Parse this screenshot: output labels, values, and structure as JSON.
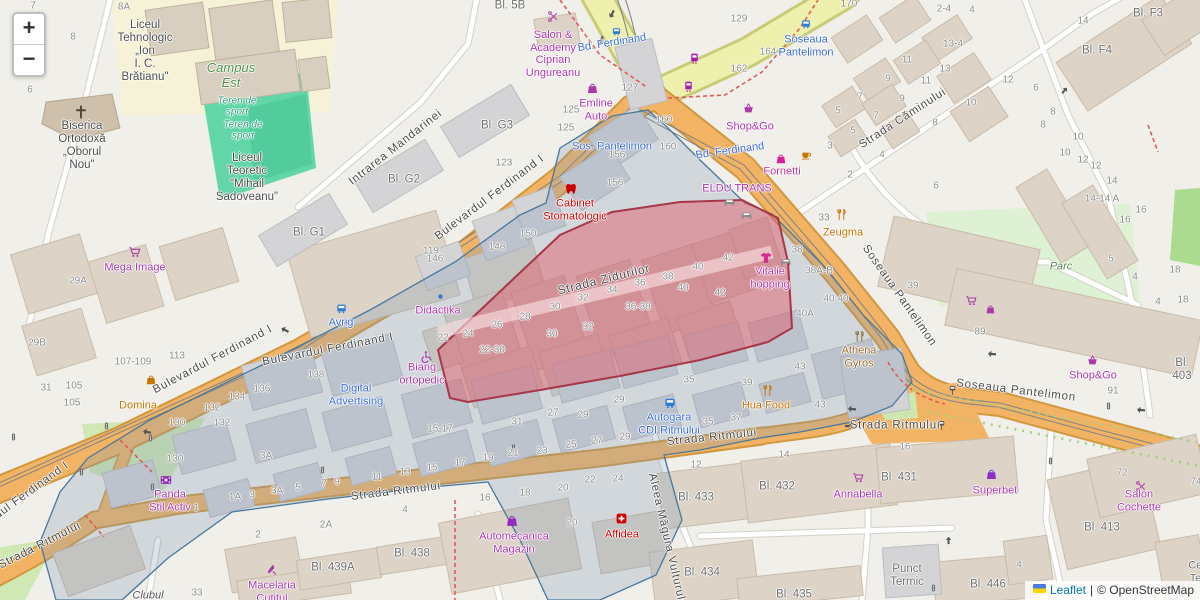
{
  "controls": {
    "zoom_in": "+",
    "zoom_out": "−"
  },
  "attribution": {
    "leaflet": "Leaflet",
    "sep": "|",
    "osm": "© OpenStreetMap"
  },
  "colors": {
    "land": "#f1efe9",
    "road_primary": "#f2b464",
    "road_primary_casing": "#d0973e",
    "road_secondary": "#eef0ad",
    "road_secondary_casing": "#c9cc77",
    "road_minor": "#ffffff",
    "road_minor_casing": "#d4d0ca",
    "building": "#ddd3c6",
    "building_gray": "#d4d4d6",
    "pitch_green": "#62d6a8",
    "park_green": "#dff1d4",
    "grass_green": "#cfe8b4",
    "schoolyard": "#f5f2d8",
    "selection_fill": "#e25563",
    "selection_stroke": "#a83648",
    "district_fill": "#7d96b4",
    "district_stroke": "#46789e",
    "poi_purple": "#ac39ac",
    "poi_blue": "#3a6cd4",
    "poi_orange": "#c77400",
    "poi_red": "#cc0000",
    "street_label": "#4a4a4a",
    "number_label": "#8b8b8b",
    "block_label": "#6e6e6e"
  },
  "streets": [
    {
      "t": "Bulevardul Ferdinand I",
      "x": 490,
      "y": 198,
      "r": -37
    },
    {
      "t": "Bulevardul Ferdinand I",
      "x": 213,
      "y": 360,
      "r": -28
    },
    {
      "t": "Bulevardul Ferdinand I",
      "x": 328,
      "y": 350,
      "r": -11
    },
    {
      "t": "Bulevardul Ferdinand I",
      "x": 14,
      "y": 504,
      "r": -36
    },
    {
      "t": "Strada Zidurilor",
      "x": 604,
      "y": 280,
      "r": -14,
      "s": 12
    },
    {
      "t": "Strada Căminului",
      "x": 903,
      "y": 119,
      "r": -33
    },
    {
      "t": "Intrarea Mandarinei",
      "x": 396,
      "y": 148,
      "r": -38
    },
    {
      "t": "Soseaua Pantelimon",
      "x": 899,
      "y": 296,
      "r": 55
    },
    {
      "t": "Soseaua Pantelimon",
      "x": 1016,
      "y": 391,
      "r": 7
    },
    {
      "t": "Strada Ritmului",
      "x": 396,
      "y": 492,
      "r": -7
    },
    {
      "t": "Strada Ritmului",
      "x": 712,
      "y": 438,
      "r": -6
    },
    {
      "t": "Strada Ritmului",
      "x": 895,
      "y": 426,
      "r": 0
    },
    {
      "t": "Strada Ritmului",
      "x": 40,
      "y": 546,
      "r": -27
    },
    {
      "t": "Aleea Măgura Vulturului",
      "x": 667,
      "y": 542,
      "r": 77
    }
  ],
  "places": [
    {
      "t": "Liceul\nTehnologic\n„Ion\nI. C.\nBrătianu\"",
      "x": 145,
      "y": 52,
      "c": "#4d4d4d",
      "s": 11.5
    },
    {
      "t": "Campus\nEst",
      "x": 231,
      "y": 76,
      "c": "#4c9245",
      "s": 13,
      "i": true
    },
    {
      "t": "Teren de\nsport",
      "x": 237,
      "y": 107,
      "c": "#2f9e82",
      "s": 10,
      "i": true
    },
    {
      "t": "Teren de\nsport",
      "x": 243,
      "y": 131,
      "c": "#2f9e82",
      "s": 10,
      "i": true
    },
    {
      "t": "Biserica\nOrtodoxă\n„Oborul\nNou\"",
      "x": 82,
      "y": 146,
      "c": "#4d4d4d",
      "s": 11.5
    },
    {
      "t": "Liceul\nTeoretic\n\"Mihail\nSadoveanu\"",
      "x": 247,
      "y": 178,
      "c": "#4d4d4d",
      "s": 11.5
    },
    {
      "t": "Mega Image",
      "x": 135,
      "y": 268,
      "c": "#ac39ac"
    },
    {
      "t": "Salon &\nAcademy\nCiprian\nUngureanu",
      "x": 553,
      "y": 54,
      "c": "#ac39ac"
    },
    {
      "t": "Emline\nAuto",
      "x": 596,
      "y": 110,
      "c": "#ac39ac"
    },
    {
      "t": "Bd. Ferdinand",
      "x": 612,
      "y": 43,
      "c": "#3a6cd4",
      "r": -9
    },
    {
      "t": "Bd. Ferdinand",
      "x": 730,
      "y": 151,
      "c": "#3a6cd4",
      "r": -8
    },
    {
      "t": "Sos. Pantelimon",
      "x": 612,
      "y": 147,
      "c": "#3a6cd4"
    },
    {
      "t": "Soseaua\nPantelimon",
      "x": 806,
      "y": 46,
      "c": "#3a6cd4"
    },
    {
      "t": "Shop&Go",
      "x": 750,
      "y": 127,
      "c": "#ac39ac"
    },
    {
      "t": "Fornetti",
      "x": 782,
      "y": 172,
      "c": "#c23a9b"
    },
    {
      "t": "ELDU TRANS",
      "x": 737,
      "y": 189,
      "c": "#ac39ac"
    },
    {
      "t": "Cabinet\nStomatologic",
      "x": 575,
      "y": 210,
      "c": "#cc0000"
    },
    {
      "t": "Didactika",
      "x": 438,
      "y": 311,
      "c": "#ac39ac"
    },
    {
      "t": "Vitalie\nhopping",
      "x": 770,
      "y": 278,
      "c": "#bc34a0"
    },
    {
      "t": "Zeugma",
      "x": 843,
      "y": 233,
      "c": "#c77400"
    },
    {
      "t": "Parc",
      "x": 1061,
      "y": 267,
      "c": "#568a56",
      "i": true
    },
    {
      "t": "Athena\nGyros",
      "x": 859,
      "y": 357,
      "c": "#9c6b2f"
    },
    {
      "t": "Shop&Go",
      "x": 1093,
      "y": 376,
      "c": "#ac39ac"
    },
    {
      "t": "Avrig",
      "x": 341,
      "y": 323,
      "c": "#3a6cd4"
    },
    {
      "t": "Digital\nAdvertising",
      "x": 356,
      "y": 395,
      "c": "#3a6cd4"
    },
    {
      "t": "Biang\nortopedic",
      "x": 422,
      "y": 374,
      "c": "#ac39ac"
    },
    {
      "t": "Autogara\nCDI Ritmului",
      "x": 669,
      "y": 424,
      "c": "#3a6cd4"
    },
    {
      "t": "Hua Food",
      "x": 766,
      "y": 406,
      "c": "#c77400"
    },
    {
      "t": "Panda\nStil Activ",
      "x": 170,
      "y": 501,
      "c": "#ac39ac"
    },
    {
      "t": "Domina",
      "x": 138,
      "y": 406,
      "c": "#c77400"
    },
    {
      "t": "Macelaria\nCutitul",
      "x": 272,
      "y": 592,
      "c": "#ac39ac"
    },
    {
      "t": "Automecanica\nMagazin",
      "x": 514,
      "y": 543,
      "c": "#ac39ac"
    },
    {
      "t": "Affidea",
      "x": 622,
      "y": 535,
      "c": "#cc0000"
    },
    {
      "t": "Annabella",
      "x": 858,
      "y": 495,
      "c": "#ac39ac"
    },
    {
      "t": "Superbet",
      "x": 995,
      "y": 491,
      "c": "#ac39ac"
    },
    {
      "t": "Salon Cochette",
      "x": 1139,
      "y": 501,
      "c": "#ac39ac"
    },
    {
      "t": "Punct\nTermic",
      "x": 907,
      "y": 576,
      "c": "#6e6e6e",
      "s": 11.5
    },
    {
      "t": "Clubul",
      "x": 148,
      "y": 596,
      "c": "#555555",
      "i": true
    },
    {
      "t": "Centrala\nTermica",
      "x": 1209,
      "y": 572,
      "c": "#6e6e6e"
    },
    {
      "t": "Bl. G3",
      "x": 497,
      "y": 126,
      "c": "#6e6e6e",
      "s": 11.5
    },
    {
      "t": "Bl. G2",
      "x": 404,
      "y": 180,
      "c": "#6e6e6e",
      "s": 11.5
    },
    {
      "t": "Bl. G1",
      "x": 309,
      "y": 233,
      "c": "#6e6e6e",
      "s": 11.5
    },
    {
      "t": "Bl. 5B",
      "x": 510,
      "y": 6,
      "c": "#6e6e6e",
      "s": 11.5
    },
    {
      "t": "Bl. F3",
      "x": 1148,
      "y": 14,
      "c": "#6e6e6e",
      "s": 11.5
    },
    {
      "t": "Bl. F4",
      "x": 1097,
      "y": 51,
      "c": "#6e6e6e",
      "s": 11.5
    },
    {
      "t": "Bl. 403",
      "x": 1182,
      "y": 370,
      "c": "#6e6e6e",
      "s": 11.5
    },
    {
      "t": "Bl. 433",
      "x": 696,
      "y": 498,
      "c": "#6e6e6e",
      "s": 11.5
    },
    {
      "t": "Bl. 432",
      "x": 777,
      "y": 487,
      "c": "#6e6e6e",
      "s": 11.5
    },
    {
      "t": "Bl. 431",
      "x": 899,
      "y": 478,
      "c": "#6e6e6e",
      "s": 11.5
    },
    {
      "t": "Bl. 434",
      "x": 702,
      "y": 573,
      "c": "#6e6e6e",
      "s": 11.5
    },
    {
      "t": "Bl. 435",
      "x": 794,
      "y": 595,
      "c": "#6e6e6e",
      "s": 11.5
    },
    {
      "t": "Bl. 446",
      "x": 988,
      "y": 585,
      "c": "#6e6e6e",
      "s": 11.5
    },
    {
      "t": "Bl. 413",
      "x": 1102,
      "y": 528,
      "c": "#6e6e6e",
      "s": 11.5
    },
    {
      "t": "Bl. 439A",
      "x": 333,
      "y": 568,
      "c": "#6e6e6e",
      "s": 11.5
    },
    {
      "t": "Bl. 438",
      "x": 412,
      "y": 554,
      "c": "#6e6e6e",
      "s": 11.5
    }
  ],
  "numbers": [
    [
      "7",
      33,
      6
    ],
    [
      "8A",
      124,
      7
    ],
    [
      "8",
      73,
      37
    ],
    [
      "6",
      30,
      90
    ],
    [
      "129",
      739,
      19
    ],
    [
      "162",
      739,
      69
    ],
    [
      "164",
      768,
      52
    ],
    [
      "170",
      849,
      4
    ],
    [
      "2-4",
      944,
      9
    ],
    [
      "4",
      972,
      10
    ],
    [
      "13-4",
      953,
      44
    ],
    [
      "13",
      945,
      69
    ],
    [
      "11",
      907,
      60
    ],
    [
      "11",
      926,
      81
    ],
    [
      "9",
      888,
      79
    ],
    [
      "9",
      902,
      99
    ],
    [
      "7",
      860,
      97
    ],
    [
      "7",
      876,
      116
    ],
    [
      "5",
      838,
      111
    ],
    [
      "5",
      853,
      131
    ],
    [
      "3",
      830,
      146
    ],
    [
      "4",
      882,
      155
    ],
    [
      "2",
      850,
      175
    ],
    [
      "6",
      936,
      186
    ],
    [
      "8",
      935,
      123
    ],
    [
      "10",
      971,
      103
    ],
    [
      "12",
      1008,
      80
    ],
    [
      "6",
      1036,
      88
    ],
    [
      "8",
      1053,
      112
    ],
    [
      "8",
      1043,
      125
    ],
    [
      "10",
      1078,
      137
    ],
    [
      "10",
      1065,
      153
    ],
    [
      "12",
      1083,
      160
    ],
    [
      "12",
      1096,
      166
    ],
    [
      "14",
      1112,
      181
    ],
    [
      "14",
      1083,
      21
    ],
    [
      "14-14 A",
      1102,
      199
    ],
    [
      "16",
      1141,
      210
    ],
    [
      "16",
      1125,
      220
    ],
    [
      "127",
      630,
      88
    ],
    [
      "125",
      571,
      110
    ],
    [
      "125",
      566,
      128
    ],
    [
      "123",
      504,
      163
    ],
    [
      "119",
      431,
      251
    ],
    [
      "150",
      528,
      234
    ],
    [
      "148",
      497,
      247
    ],
    [
      "146",
      435,
      259
    ],
    [
      "156",
      617,
      155
    ],
    [
      "156",
      615,
      183
    ],
    [
      "160",
      664,
      120
    ],
    [
      "160",
      668,
      147
    ],
    [
      "22",
      443,
      338
    ],
    [
      "24",
      468,
      334
    ],
    [
      "26",
      497,
      325
    ],
    [
      "28",
      525,
      317
    ],
    [
      "30",
      555,
      307
    ],
    [
      "30",
      552,
      334
    ],
    [
      "32",
      583,
      298
    ],
    [
      "32",
      588,
      327
    ],
    [
      "34",
      612,
      290
    ],
    [
      "36",
      640,
      283
    ],
    [
      "36-38",
      638,
      307
    ],
    [
      "38",
      668,
      277
    ],
    [
      "40",
      698,
      267
    ],
    [
      "40",
      683,
      288
    ],
    [
      "42",
      728,
      258
    ],
    [
      "42",
      720,
      293
    ],
    [
      "22-30",
      492,
      350
    ],
    [
      "38",
      797,
      250
    ],
    [
      "38A-B",
      819,
      271
    ],
    [
      "40",
      829,
      299
    ],
    [
      "40",
      843,
      299
    ],
    [
      "40A",
      805,
      314
    ],
    [
      "33",
      824,
      218
    ],
    [
      "39",
      913,
      286
    ],
    [
      "89",
      980,
      332
    ],
    [
      "91",
      1113,
      391
    ],
    [
      "5",
      1111,
      259
    ],
    [
      "4",
      1135,
      277
    ],
    [
      "18",
      1175,
      270
    ],
    [
      "4",
      1158,
      302
    ],
    [
      "18",
      1183,
      300
    ],
    [
      "9",
      337,
      482
    ],
    [
      "11",
      377,
      477
    ],
    [
      "13",
      405,
      472
    ],
    [
      "15",
      432,
      468
    ],
    [
      "17",
      460,
      463
    ],
    [
      "19",
      488,
      458
    ],
    [
      "21",
      513,
      453
    ],
    [
      "23",
      542,
      451
    ],
    [
      "25",
      571,
      445
    ],
    [
      "27",
      597,
      441
    ],
    [
      "29",
      625,
      437
    ],
    [
      "15-17",
      440,
      429
    ],
    [
      "31",
      517,
      422
    ],
    [
      "27",
      553,
      413
    ],
    [
      "29",
      583,
      415
    ],
    [
      "29",
      619,
      400
    ],
    [
      "35",
      689,
      380
    ],
    [
      "39",
      747,
      383
    ],
    [
      "43",
      800,
      367
    ],
    [
      "35",
      708,
      422
    ],
    [
      "37",
      736,
      418
    ],
    [
      "43",
      820,
      405
    ],
    [
      "4",
      405,
      510
    ],
    [
      "16",
      485,
      498
    ],
    [
      "18",
      525,
      493
    ],
    [
      "20",
      563,
      488
    ],
    [
      "22",
      590,
      480
    ],
    [
      "24",
      618,
      479
    ],
    [
      "20",
      572,
      523
    ],
    [
      "12",
      696,
      465
    ],
    [
      "14",
      784,
      455
    ],
    [
      "16",
      905,
      447
    ],
    [
      "2",
      258,
      535
    ],
    [
      "2A",
      326,
      525
    ],
    [
      "1",
      196,
      508
    ],
    [
      "1A",
      235,
      497
    ],
    [
      "3",
      252,
      495
    ],
    [
      "3A",
      277,
      491
    ],
    [
      "5",
      298,
      488
    ],
    [
      "7",
      324,
      484
    ],
    [
      "3A",
      266,
      456
    ],
    [
      "33",
      197,
      593
    ],
    [
      "31",
      46,
      388
    ],
    [
      "105",
      74,
      386
    ],
    [
      "105",
      72,
      403
    ],
    [
      "107-109",
      133,
      362
    ],
    [
      "113",
      177,
      356
    ],
    [
      "130",
      177,
      423
    ],
    [
      "132",
      212,
      408
    ],
    [
      "132",
      222,
      423
    ],
    [
      "134",
      237,
      397
    ],
    [
      "136",
      262,
      389
    ],
    [
      "138",
      316,
      375
    ],
    [
      "130",
      175,
      459
    ],
    [
      "29A",
      78,
      281
    ],
    [
      "29B",
      37,
      343
    ],
    [
      "72",
      1122,
      473
    ],
    [
      "74",
      1196,
      482
    ],
    [
      "4",
      1019,
      565
    ]
  ],
  "icons": [
    [
      "cart",
      135,
      252,
      "#ac39ac",
      14,
      0
    ],
    [
      "cart",
      971,
      300,
      "#ac39ac",
      13,
      0
    ],
    [
      "cart",
      858,
      477,
      "#ac39ac",
      13,
      0
    ],
    [
      "bag",
      990,
      309,
      "#ac39ac",
      11,
      0
    ],
    [
      "basket",
      748,
      108,
      "#ac39ac",
      13,
      0
    ],
    [
      "basket",
      1092,
      360,
      "#ac39ac",
      13,
      0
    ],
    [
      "bag",
      592,
      88,
      "#ac39ac",
      13,
      0
    ],
    [
      "bag",
      781,
      159,
      "#d81b9b",
      12,
      0
    ],
    [
      "bag",
      151,
      380,
      "#c77400",
      12,
      0
    ],
    [
      "bag",
      512,
      521,
      "#9429bd",
      14,
      0
    ],
    [
      "bag",
      991,
      474,
      "#8b2fc9",
      13,
      0
    ],
    [
      "scissors",
      553,
      16,
      "#ac39ac",
      13,
      0
    ],
    [
      "scissors",
      1141,
      486,
      "#ac39ac",
      13,
      0
    ],
    [
      "tram",
      694,
      58,
      "#a21caf",
      13,
      0
    ],
    [
      "tram",
      688,
      86,
      "#a21caf",
      13,
      0
    ],
    [
      "bus",
      806,
      24,
      "#2e7cd6",
      12,
      0
    ],
    [
      "bus",
      616,
      31,
      "#2e7cd6",
      11,
      0
    ],
    [
      "bus",
      341,
      308,
      "#2e7cd6",
      13,
      0
    ],
    [
      "bus",
      670,
      403,
      "#2e7cd6",
      14,
      0
    ],
    [
      "cup",
      806,
      155,
      "#c77400",
      12,
      0
    ],
    [
      "tooth",
      571,
      189,
      "#cc0000",
      14,
      0
    ],
    [
      "medcross",
      621,
      518,
      "#d40000",
      13,
      0
    ],
    [
      "fork",
      841,
      214,
      "#c77400",
      13,
      0
    ],
    [
      "fork",
      767,
      390,
      "#c77400",
      13,
      0
    ],
    [
      "fork",
      859,
      336,
      "#8a6d3b",
      13,
      0
    ],
    [
      "shirt",
      766,
      258,
      "#d52b8f",
      14,
      0
    ],
    [
      "film",
      166,
      480,
      "#9429bd",
      14,
      0
    ],
    [
      "knife",
      271,
      569,
      "#ac39ac",
      13,
      0
    ],
    [
      "crossch",
      81,
      112,
      "#4f463a",
      16,
      0
    ],
    [
      "wheelchair",
      426,
      356,
      "#ac39ac",
      13,
      0
    ],
    [
      "car",
      729,
      201,
      "#8a8a8a",
      13,
      0
    ],
    [
      "car",
      746,
      214,
      "#8a8a8a",
      13,
      0
    ],
    [
      "car",
      786,
      261,
      "#8a8a8a",
      12,
      0
    ],
    [
      "dot",
      440,
      296,
      "#4a78c8",
      9,
      0
    ],
    [
      "trafficlight",
      150,
      438,
      "#666666",
      9,
      0
    ],
    [
      "trafficlight",
      152,
      487,
      "#666666",
      9,
      0
    ],
    [
      "trafficlight",
      13,
      437,
      "#666666",
      9,
      0
    ],
    [
      "trafficlight",
      27,
      552,
      "#666666",
      9,
      0
    ],
    [
      "trafficlight",
      322,
      470,
      "#666666",
      9,
      0
    ],
    [
      "trafficlight",
      513,
      448,
      "#666666",
      9,
      0
    ],
    [
      "trafficlight",
      1050,
      461,
      "#666666",
      9,
      0
    ],
    [
      "trafficlight",
      1108,
      406,
      "#666666",
      9,
      0
    ],
    [
      "trafficlight",
      106,
      426,
      "#666666",
      9,
      0
    ],
    [
      "trafficlight",
      81,
      472,
      "#666666",
      9,
      0
    ],
    [
      "trafficlight",
      933,
      588,
      "#666666",
      9,
      0
    ],
    [
      "busstop",
      952,
      390,
      "#555555",
      11,
      0
    ],
    [
      "busstop",
      941,
      425,
      "#555555",
      11,
      0
    ],
    [
      "arrow",
      612,
      14,
      "#555555",
      10,
      117
    ],
    [
      "arrow",
      601,
      40,
      "#555555",
      10,
      117
    ],
    [
      "arrow",
      285,
      330,
      "#555555",
      10,
      208
    ],
    [
      "arrow",
      147,
      432,
      "#555555",
      10,
      192
    ],
    [
      "arrow",
      992,
      354,
      "#555555",
      10,
      185
    ],
    [
      "arrow",
      1141,
      410,
      "#555555",
      10,
      185
    ],
    [
      "arrow",
      852,
      409,
      "#555555",
      10,
      185
    ],
    [
      "arrow",
      849,
      426,
      "#555555",
      10,
      0
    ],
    [
      "arrow",
      948,
      540,
      "#555555",
      9,
      -90
    ],
    [
      "arrow",
      1064,
      90,
      "#555555",
      9,
      -50
    ]
  ]
}
